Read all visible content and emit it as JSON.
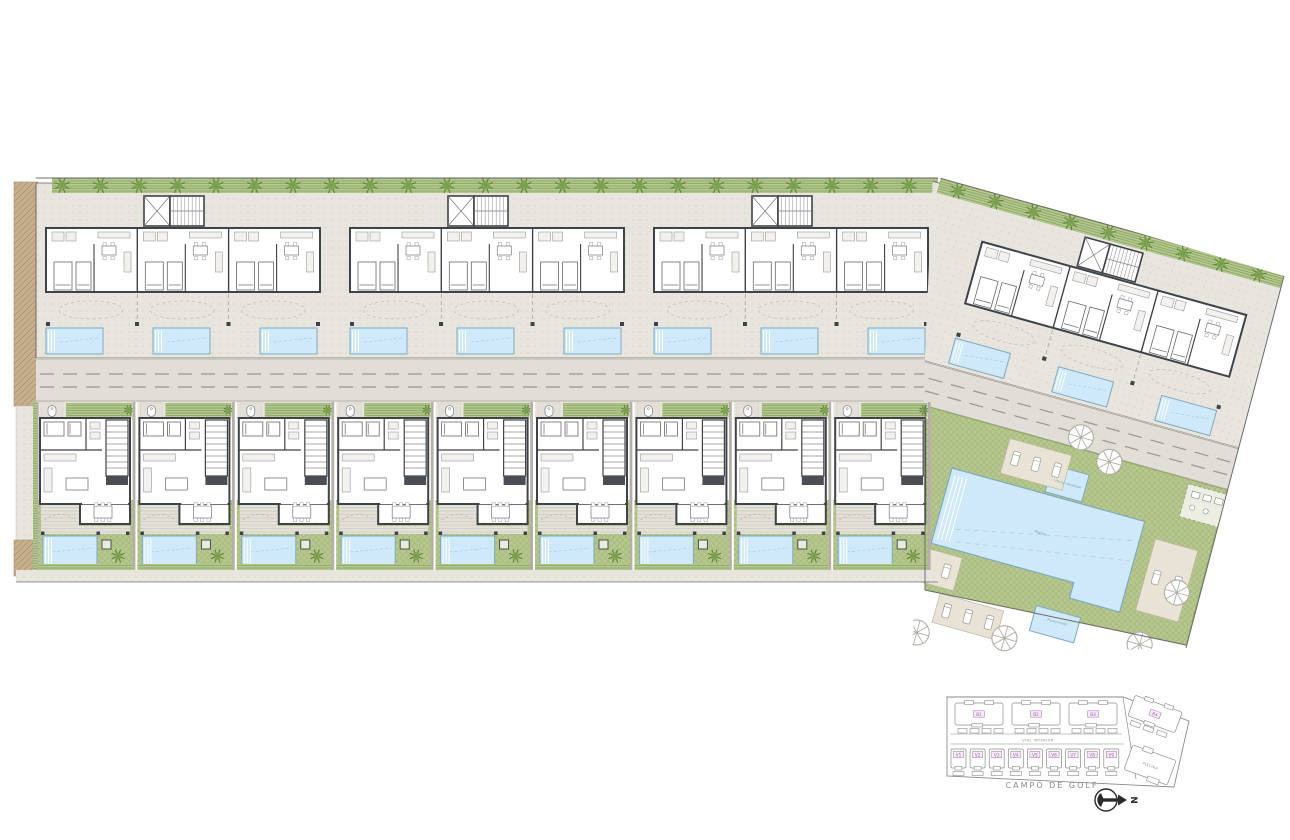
{
  "labels": {
    "campo_de_golf": "CAMPO DE GOLF",
    "vial_interior": "VIAL INTERIOR",
    "north": "N",
    "piscina": "PISCINA",
    "pool_main": "Piscina",
    "pool_spa": "Piscina climatizada",
    "pool_kids": "Piscina infantil"
  },
  "key_plan": {
    "blocks": [
      "B1",
      "B2",
      "B3",
      "B4"
    ],
    "villas": [
      "V1",
      "V2",
      "V3",
      "V4",
      "V5",
      "V6",
      "V7",
      "V8",
      "V9"
    ]
  },
  "site": {
    "villa_count": 9,
    "straight_block_count": 3,
    "angled_block_count": 1,
    "pools_per_block": 3,
    "villa_pool_count": 9,
    "communal_pool_count": 3,
    "trees_top_row": 23,
    "trees_angled_row": 9,
    "parasol_count": 10,
    "lounger_pad_count": 7
  },
  "colors": {
    "wall": "#3f4247",
    "deck": "#e8e5df",
    "deck_line": "#d6d2cb",
    "decking": "#e3e0d9",
    "decking_line": "#cdc9c1",
    "road": "#e1ded7",
    "road_dot": "#d6d2ca",
    "road_dash": "#9b968e",
    "curb": "#a7a29a",
    "lawn": "#b7c78d",
    "lawn_line": "#9fb478",
    "hedge": "#b7c996",
    "hedge_line": "#8ba95e",
    "tree": "#7da351",
    "tree_dark": "#5d8038",
    "palm": "#7fa24f",
    "pool": "#cfe9f8",
    "pool_edge": "#7fa9c0",
    "pool_line": "#a6cde1",
    "tan": "#c7b08e",
    "tan_line": "#a9906c",
    "furniture": "#8a8a8a",
    "furniture_fill": "#f2f1ee",
    "boundary": "#6b6b6b",
    "keyplan_line": "#8a8a8a",
    "label_box_stroke": "#b77fc0",
    "label_box_fill": "#f6ecf7",
    "label_text": "#9a5fae",
    "pad": "#e9e3d6",
    "pad_stroke": "#bdb5a4",
    "north_ink": "#2b2b2b"
  }
}
